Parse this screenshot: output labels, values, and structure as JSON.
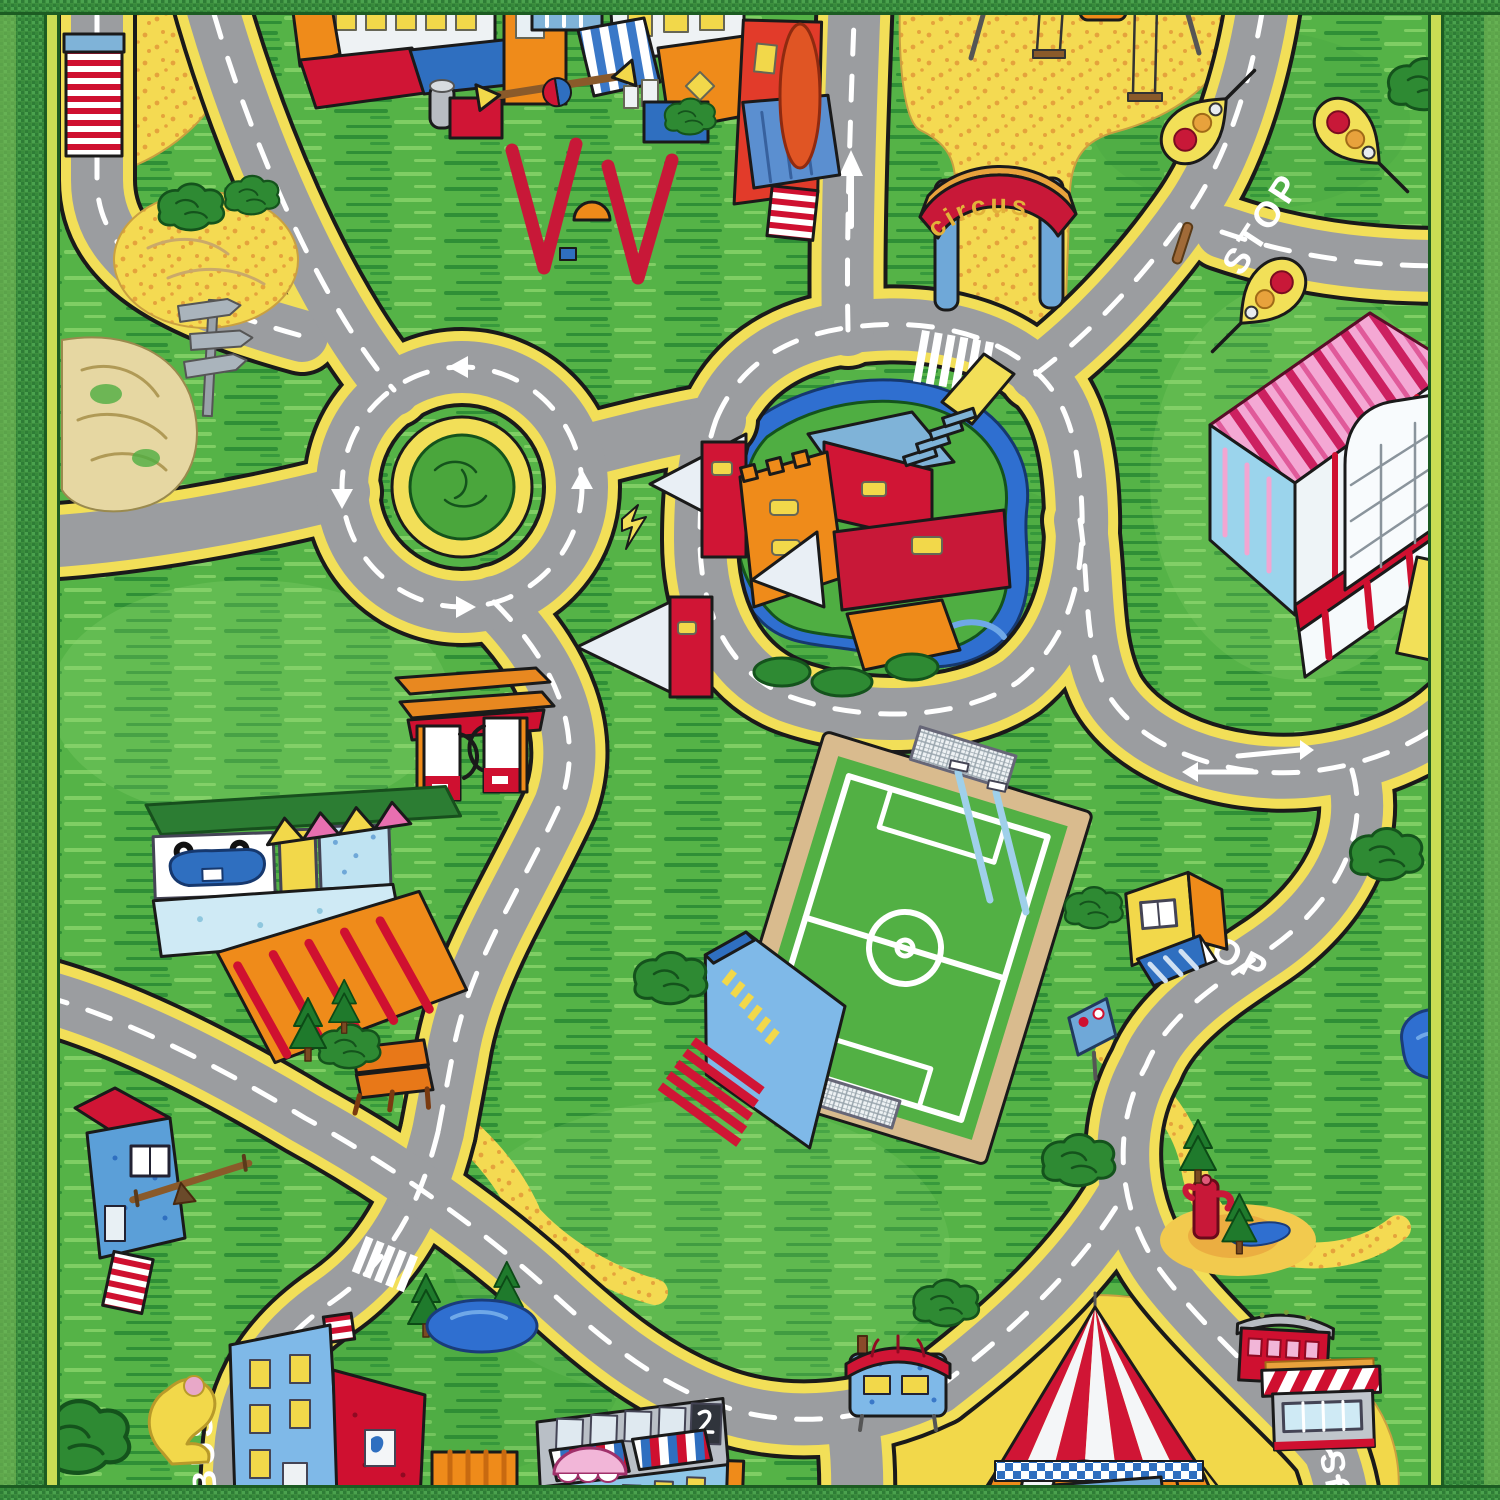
{
  "labels": {
    "circus_arch": "circus",
    "stop": "STOP",
    "bus": "BUS",
    "supermarket_sign": "SUP"
  },
  "landmarks": [
    "roundabout",
    "castle-with-moat",
    "supermarket",
    "soccer-field",
    "grandstand",
    "gas-station",
    "garage-showroom",
    "circus-arch",
    "circus-big-top",
    "circus-caravans",
    "playground-swings",
    "playground-climber",
    "town-houses",
    "apartment-buildings",
    "park-bench",
    "pine-woods",
    "ponds",
    "water-pump",
    "traffic-lights",
    "kiosk",
    "signpost"
  ],
  "colors": {
    "grass": "#55b347",
    "grass_streak_dark": "#2f8f36",
    "grass_streak_light": "#7fce64",
    "road": "#9b9da0",
    "road_line": "#ffffff",
    "sidewalk_yellow": "#f2df58",
    "sand": "#f4da52",
    "water": "#2f6fd0",
    "outline": "#1a1a1a",
    "border_green": "#3d8f3f",
    "border_stripe": "#c9dd54",
    "castle_red": "#d01535",
    "castle_orange": "#ef8b1a",
    "supermarket_pink": "#f4a8d4",
    "tent_red": "#d01535",
    "caravan_blue": "#7fb9e8"
  }
}
